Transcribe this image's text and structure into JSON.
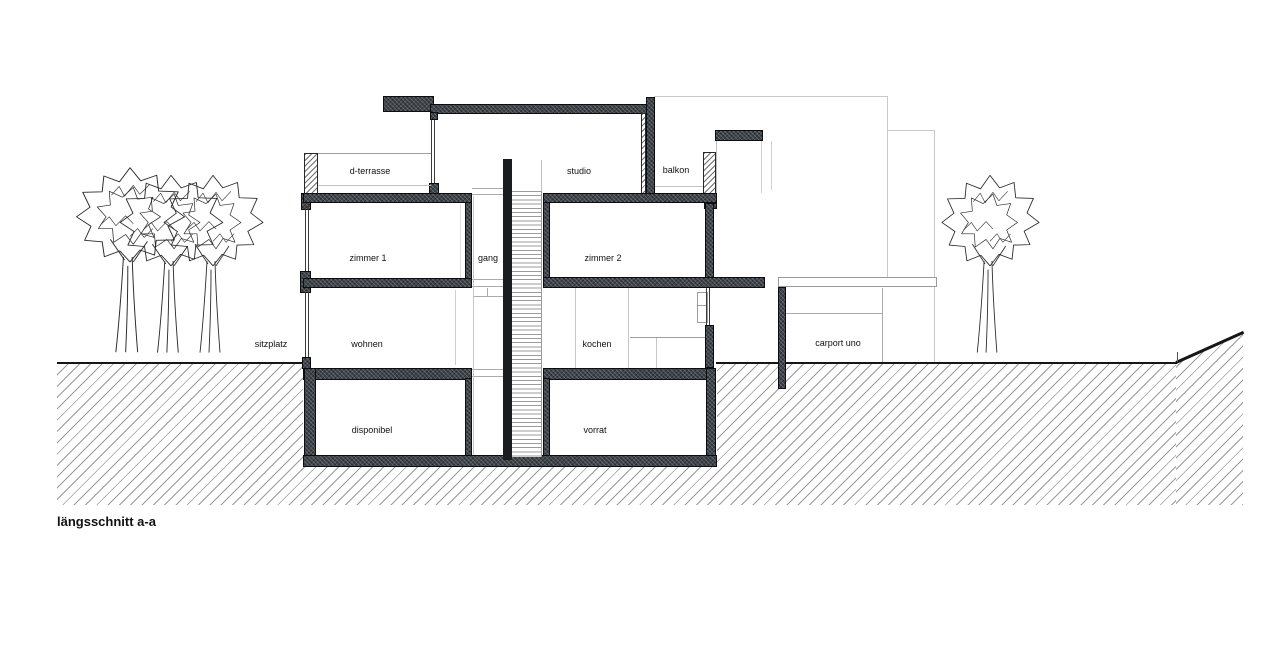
{
  "title": "längsschnitt a-a",
  "labels": {
    "d_terrasse": "d-terrasse",
    "studio": "studio",
    "balkon": "balkon",
    "zimmer1": "zimmer 1",
    "gang": "gang",
    "zimmer2": "zimmer 2",
    "sitzplatz": "sitzplatz",
    "wohnen": "wohnen",
    "kochen": "kochen",
    "carport": "carport uno",
    "disponibel": "disponibel",
    "vorrat": "vorrat"
  },
  "colors": {
    "wall-dark": "#3f444a",
    "wall-black": "#1b1c1f",
    "line-dark": "#161616",
    "hatch-line": "#9a9a9a",
    "faint-line": "#c9c9c9",
    "text": "#111111",
    "background": "#ffffff"
  }
}
